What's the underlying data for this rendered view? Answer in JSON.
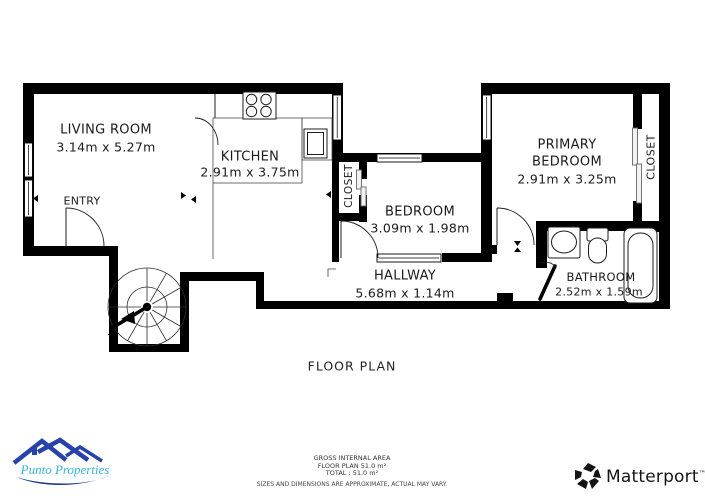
{
  "title": "FLOOR PLAN",
  "rooms": {
    "living_room": {
      "name": "LIVING ROOM",
      "dims": "3.14m x 5.27m"
    },
    "kitchen": {
      "name": "KITCHEN",
      "dims": "2.91m x 3.75m"
    },
    "entry": {
      "name": "ENTRY"
    },
    "bedroom": {
      "name": "BEDROOM",
      "dims": "3.09m x 1.98m"
    },
    "primary_bedroom": {
      "name_line1": "PRIMARY",
      "name_line2": "BEDROOM",
      "dims": "2.91m x 3.25m"
    },
    "hallway": {
      "name": "HALLWAY",
      "dims": "5.68m x 1.14m"
    },
    "bathroom": {
      "name": "BATHROOM",
      "dims": "2.52m x 1.59m"
    },
    "closet_middle": {
      "name": "CLOSET"
    },
    "closet_primary": {
      "name": "CLOSET"
    }
  },
  "footer": {
    "gross_label": "GROSS INTERNAL AREA",
    "floor_line": "FLOOR PLAN 51.0 m²",
    "total_line": "TOTAL :  51.0 m²",
    "disclaimer": "SIZES AND DIMENSIONS ARE APPROXIMATE, ACTUAL MAY VARY."
  },
  "branding": {
    "punto": {
      "name": "Punto Properties"
    },
    "matterport": {
      "name": "Matterport",
      "trademark": "™"
    }
  },
  "colors": {
    "wall": "#000000",
    "punto_roof_blue": "#2742a8",
    "punto_text_cyan": "#35b4dd",
    "punto_wave_navy": "#1b3a8c",
    "matterport_black": "#141414"
  },
  "icons": {
    "spiral-staircase-icon": "fan of treads with walk line",
    "stove-icon": "4-burner cooktop",
    "sink-icon": "oval basin",
    "toilet-icon": "tank and bowl",
    "bathtub-icon": "rounded tub",
    "matterport-logo-icon": "pinwheel mark",
    "punto-roof-icon": "rooftops",
    "punto-wave-icon": "swoosh"
  }
}
